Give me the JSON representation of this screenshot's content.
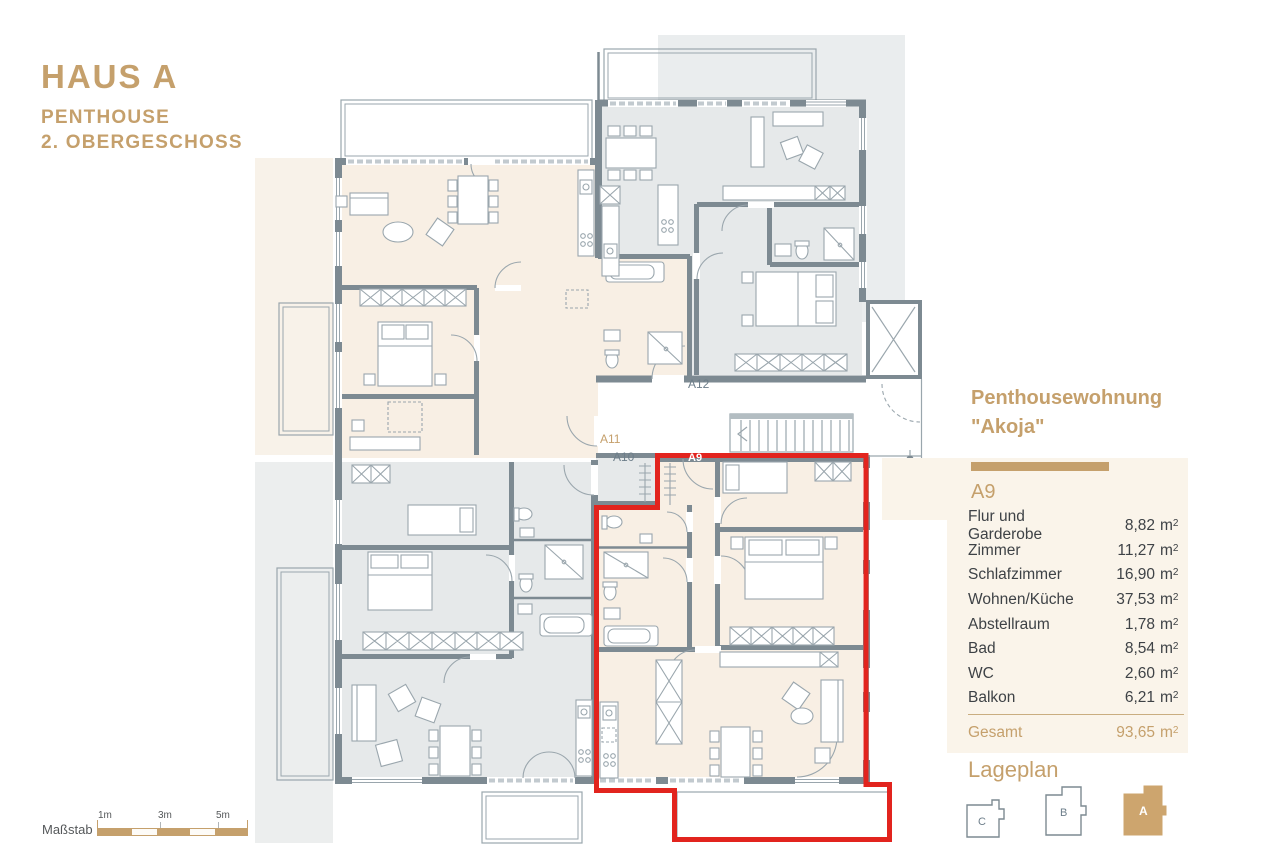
{
  "title_block": {
    "title": "HAUS A",
    "subtitle1": "PENTHOUSE",
    "subtitle2": "2. OBERGESCHOSS"
  },
  "unit_panel": {
    "heading_line1": "Penthousewohnung",
    "heading_line2": "\"Akoja\"",
    "unit_id": "A9",
    "unit": "m",
    "unit_sup": "2",
    "rooms": [
      {
        "label": "Flur und Garderobe",
        "value": "8,82"
      },
      {
        "label": "Zimmer",
        "value": "11,27"
      },
      {
        "label": "Schlafzimmer",
        "value": "16,90"
      },
      {
        "label": "Wohnen/Küche",
        "value": "37,53"
      },
      {
        "label": "Abstellraum",
        "value": "1,78"
      },
      {
        "label": "Bad",
        "value": "8,54"
      },
      {
        "label": "WC",
        "value": "2,60"
      },
      {
        "label": "Balkon",
        "value": "6,21"
      }
    ],
    "total_label": "Gesamt",
    "total_value": "93,65"
  },
  "lageplan": {
    "heading": "Lageplan",
    "buildings": [
      {
        "id": "C",
        "active": false
      },
      {
        "id": "B",
        "active": false
      },
      {
        "id": "A",
        "active": true
      }
    ]
  },
  "scale_bar": {
    "label": "Maßstab",
    "ticks": [
      "1m",
      "3m",
      "5m"
    ]
  },
  "floorplan": {
    "unit_labels": {
      "a9": "A9",
      "a10": "A10",
      "a11": "A11",
      "a12": "A12"
    }
  },
  "colors": {
    "accent_gold": "#c5a06c",
    "outline_red": "#e2241e",
    "wall_gray": "#7d8a92",
    "room_beige": "#f8efe4",
    "room_gray": "#e6e9ea"
  }
}
